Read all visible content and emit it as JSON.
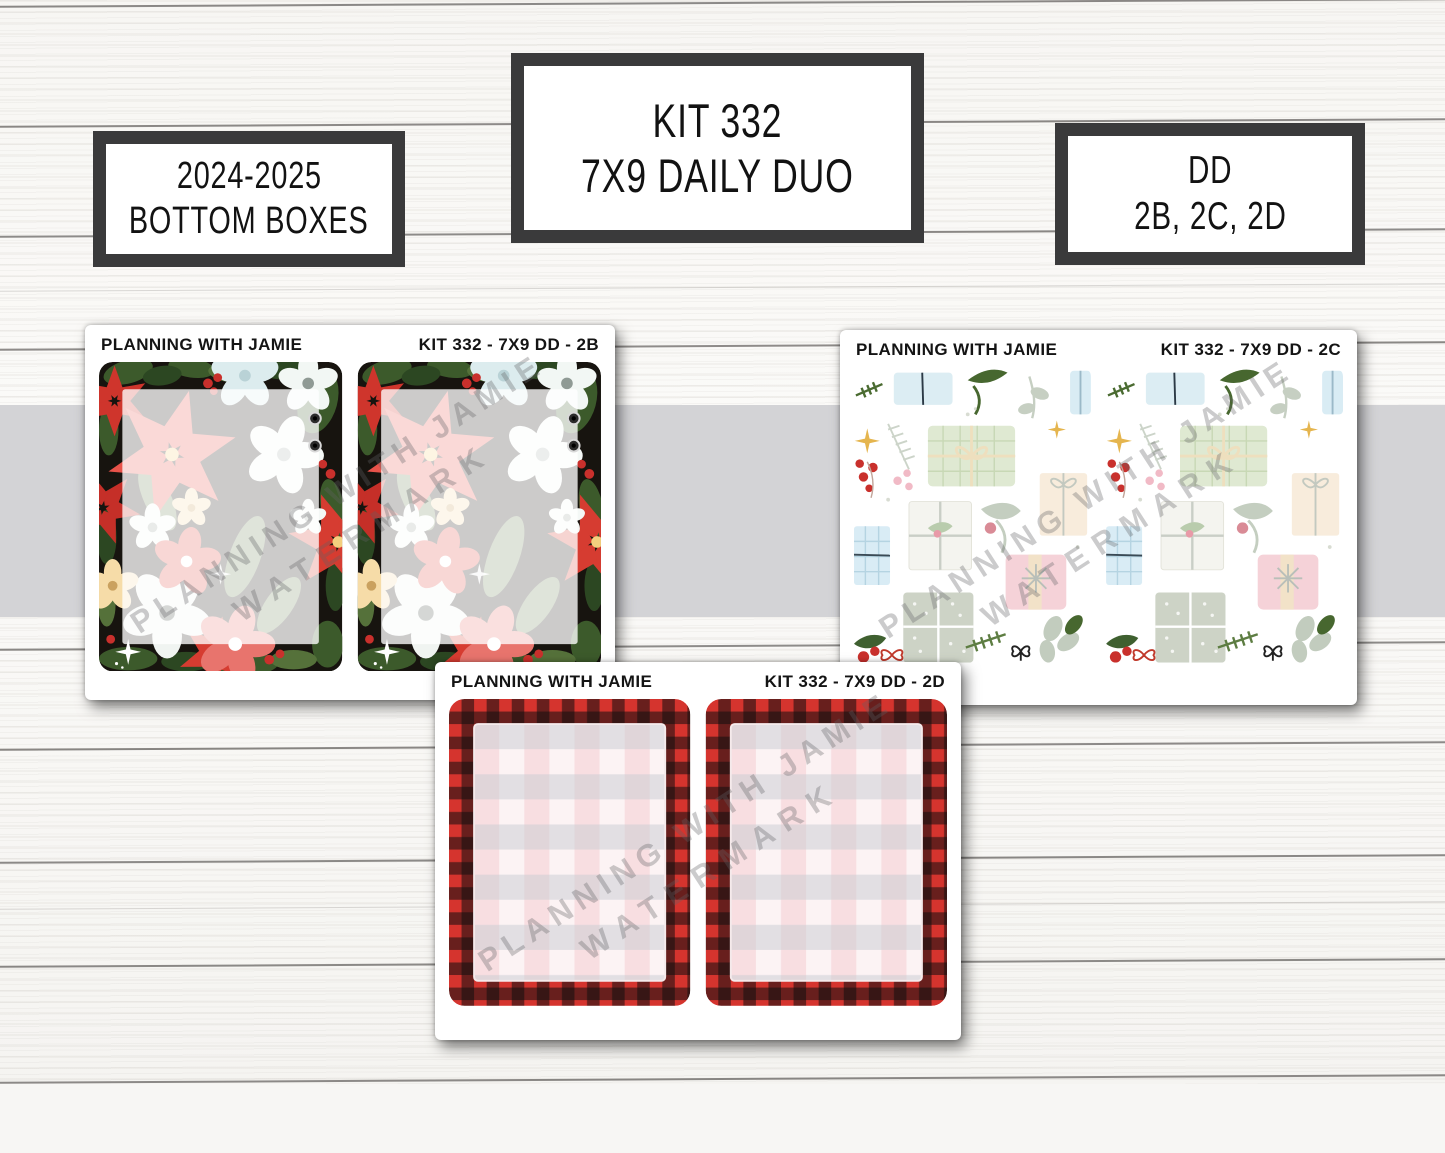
{
  "labels": {
    "left": {
      "line1": "2024-2025",
      "line2": "BOTTOM BOXES"
    },
    "center": {
      "line1": "KIT 332",
      "line2": "7X9 DAILY DUO"
    },
    "right": {
      "line1": "DD",
      "line2": "2B, 2C, 2D"
    }
  },
  "sheets": [
    {
      "id": "2B",
      "brand": "PLANNING WITH JAMIE",
      "code": "KIT 332 - 7X9 DD - 2B",
      "design": "christmas-floral-frosted-boxes",
      "box_count": 2
    },
    {
      "id": "2C",
      "brand": "PLANNING WITH JAMIE",
      "code": "KIT 332 - 7X9 DD - 2C",
      "design": "christmas-gifts-pattern-boxes",
      "box_count": 2
    },
    {
      "id": "2D",
      "brand": "PLANNING WITH JAMIE",
      "code": "KIT 332 - 7X9 DD - 2D",
      "design": "buffalo-plaid-gingham-boxes",
      "box_count": 2
    }
  ],
  "watermark": {
    "line1": "PLANNING WITH JAMIE",
    "line2": "WATERMARK"
  },
  "colors": {
    "frame_border": "#3a3a3b",
    "gray_band": "#d3d3d6",
    "plaid_red": "#d5342e",
    "poinsettia_red": "#d63c31",
    "holly_green": "#47672f",
    "berry_red": "#c9302c",
    "floral_background": "#17140f",
    "pastel_green_gift": "#dfe9d2",
    "pastel_blue_gift": "#dcedf3",
    "pastel_pink_gift": "#f5d2d8",
    "gingham_pink": "#f3ccd1",
    "gingham_gray": "#c7ccd1"
  }
}
